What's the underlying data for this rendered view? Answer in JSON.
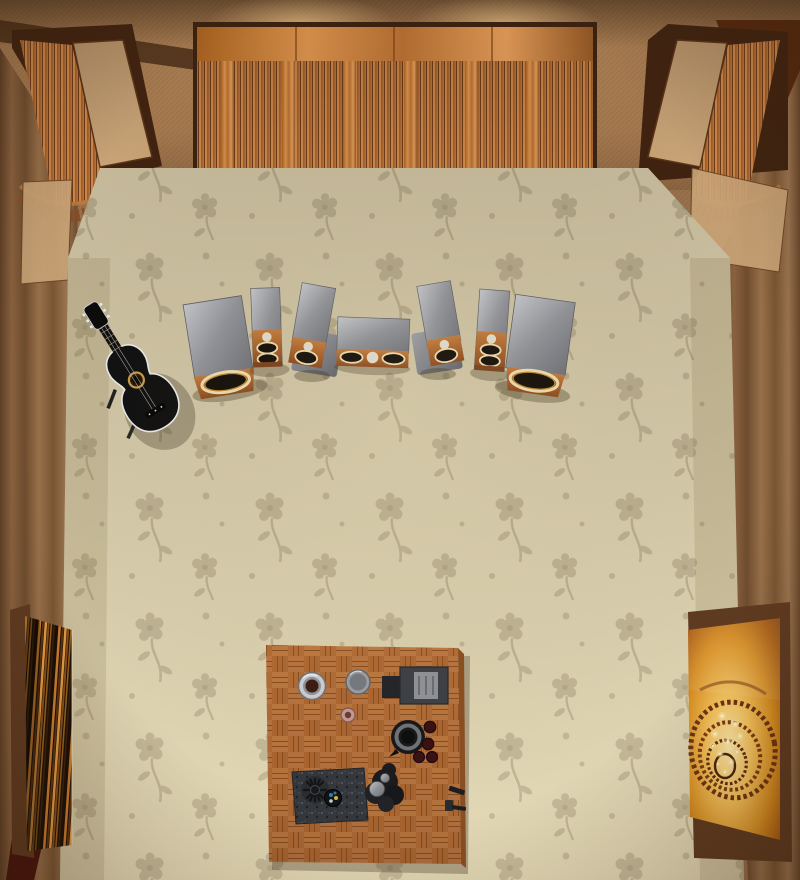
{
  "scene": {
    "name": "audio-listening-room-top-down-view",
    "view": "overhead",
    "room_elements": [
      "fabric-curtain-walls",
      "wood-slat-acoustic-diffuser-top-wall",
      "corner-acoustic-diffuser-left",
      "corner-acoustic-diffuser-right",
      "tan-absorber-panels",
      "floral-carpet-floor",
      "seven-piece-speaker-set",
      "acoustic-guitar-on-stand",
      "wood-parquet-table-with-audio-gear",
      "abstract-streak-artwork-left-wall",
      "spiral-staircase-artwork-right-wall"
    ],
    "speakers": [
      "subwoofer-left",
      "tower-left",
      "bookshelf-left-on-stand",
      "center-channel",
      "bookshelf-right-on-stand",
      "tower-right",
      "subwoofer-right"
    ],
    "table_items": [
      "metal-coffee-cup",
      "gray-mug",
      "electronics-box",
      "coaster",
      "black-kettle",
      "small-cups",
      "granite-tray",
      "finned-driver-part",
      "parts-cup",
      "metal-sculpture-parts",
      "small-black-tools"
    ]
  },
  "palette": {
    "wall_base": "#97714c",
    "wall_dark": "#5d3c22",
    "curtain_mid": "#8a6240",
    "panel_tan": "#c8a377",
    "wood_mid": "#b5713a",
    "wood_light": "#d38f4e",
    "wood_dark": "#6e3c19",
    "carpet_base": "#e4dab7",
    "carpet_motif": "#bdb090",
    "metal_gray": "#8e9095",
    "stand_gray": "#84868c",
    "speaker_wood": "#9c5526",
    "driver_ring": "#ead9ac",
    "driver_gold": "#b98a2e",
    "driver_cone": "#15100a",
    "table_wood": "#b26c36",
    "table_wood_light": "#bc7840",
    "table_wood_dark": "#8a4e20",
    "granite": "#34373c",
    "guitar_black": "#111111",
    "guitar_binding": "#e9e9e9",
    "frame_brown": "#5e3a20",
    "art_amber": "#e8a83c",
    "maroon_fold": "#47130d"
  }
}
